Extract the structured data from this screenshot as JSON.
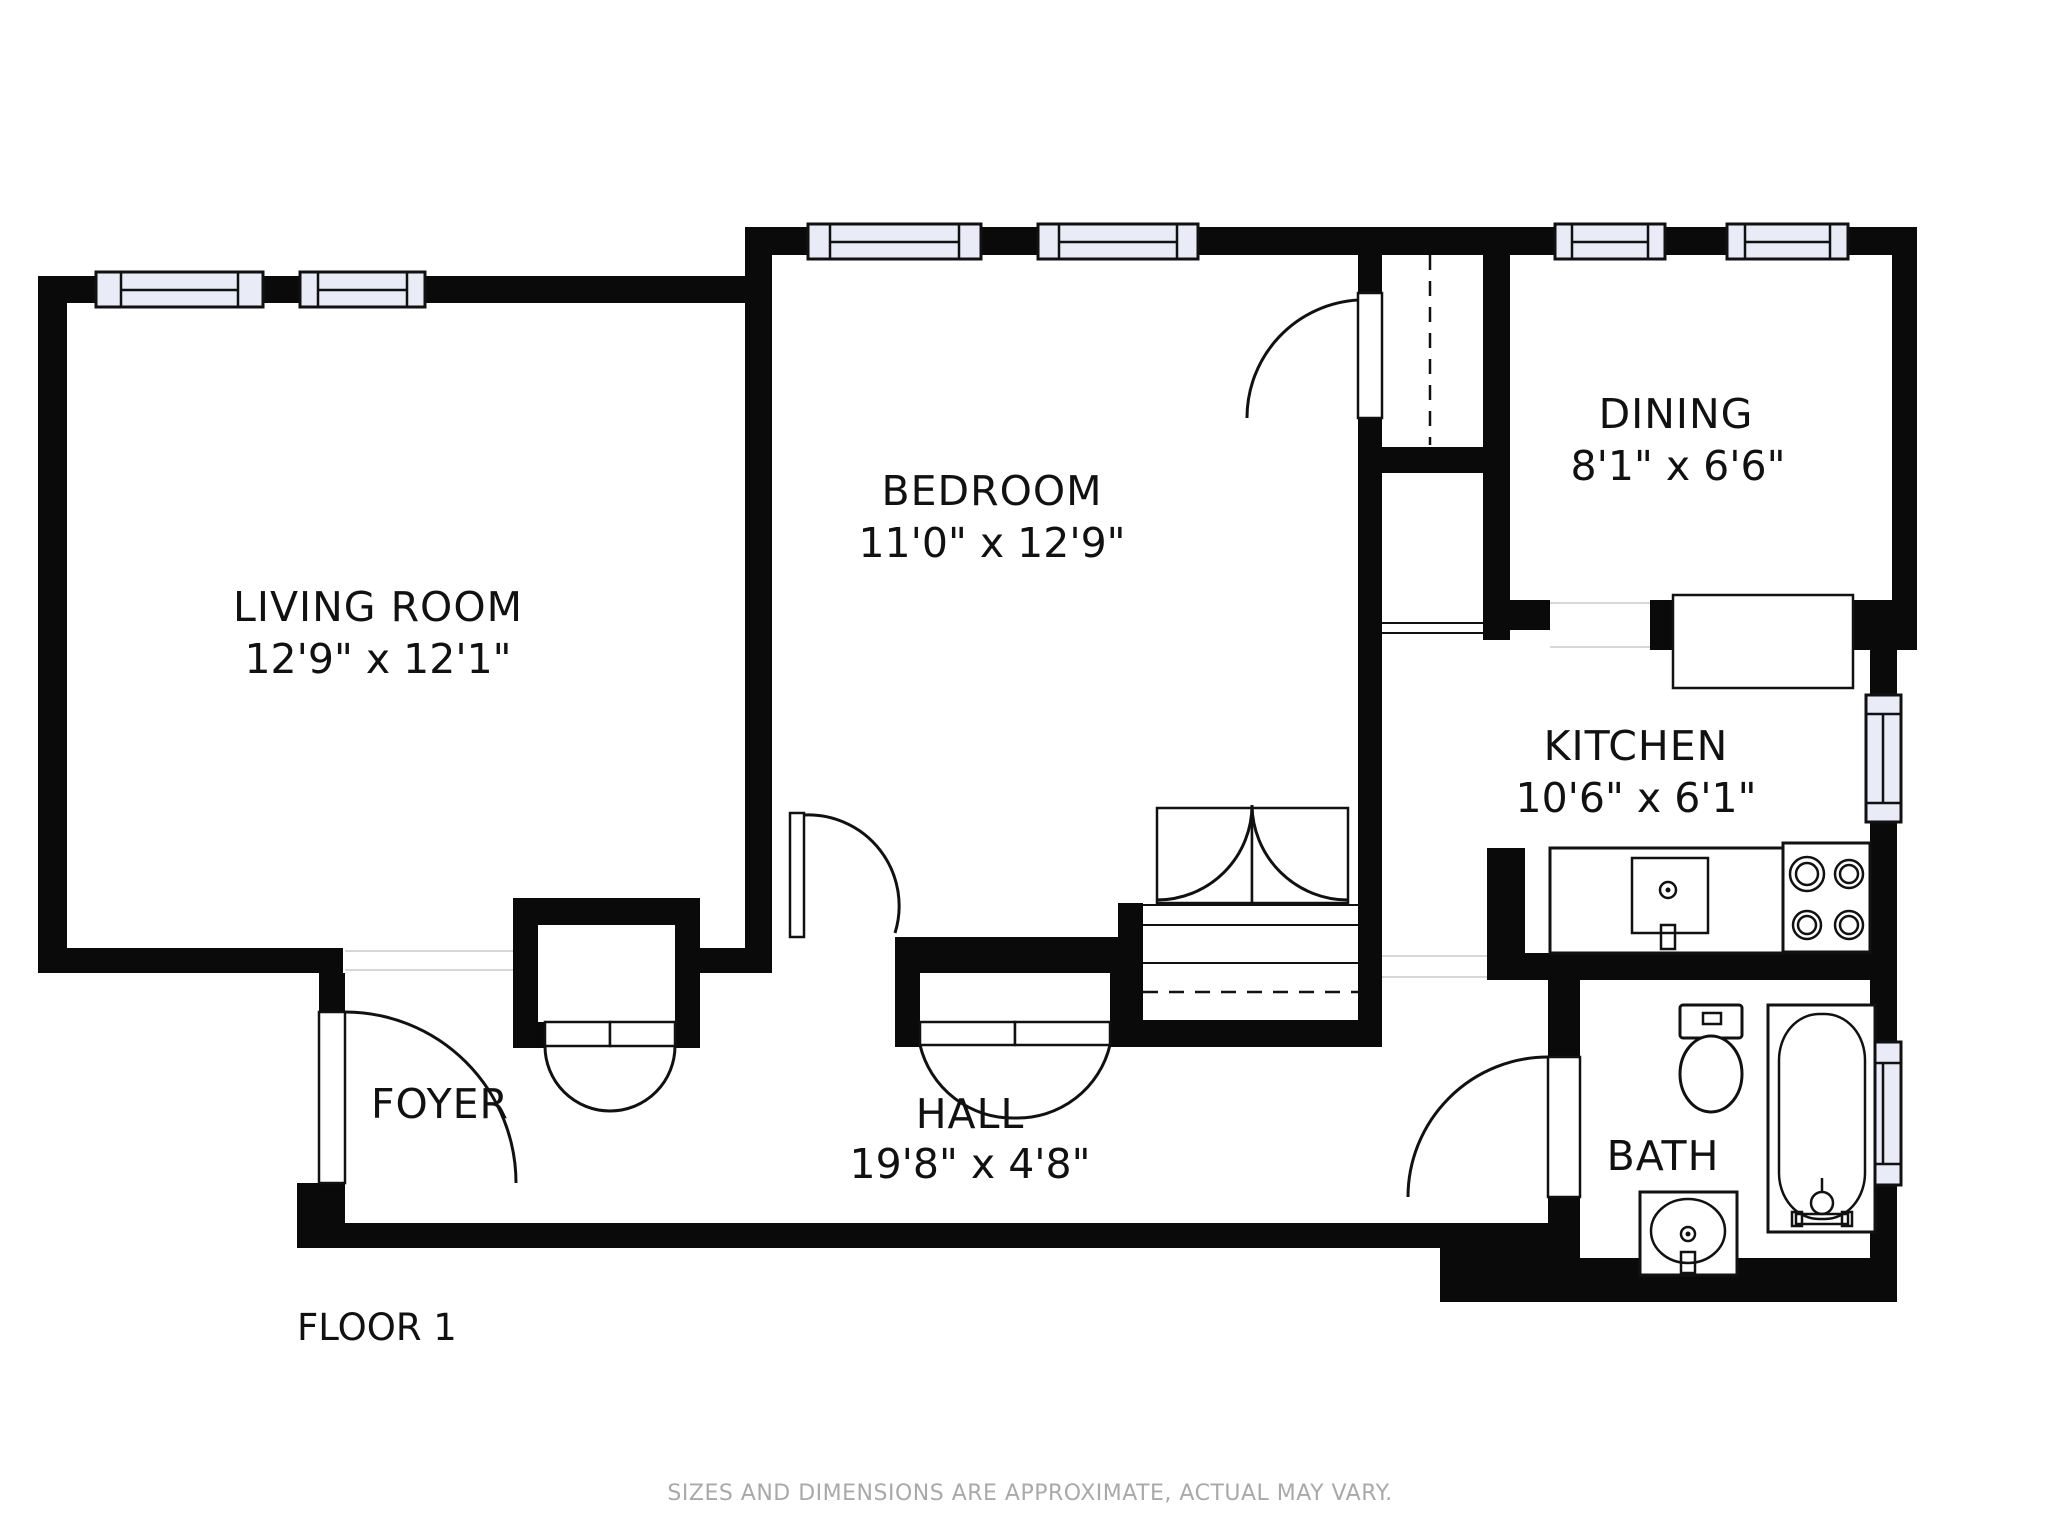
{
  "floorplan": {
    "floor_label": "FLOOR 1",
    "disclaimer": "SIZES AND DIMENSIONS ARE APPROXIMATE, ACTUAL MAY VARY.",
    "colors": {
      "wall": "#0a0a0a",
      "window_fill": "#e9ebf7",
      "label_text": "#111111",
      "disclaimer_text": "#a9a9a9"
    },
    "rooms": {
      "living_room": {
        "name": "LIVING ROOM",
        "dims": "12'9\" x 12'1\""
      },
      "bedroom": {
        "name": "BEDROOM",
        "dims": "11'0\" x 12'9\""
      },
      "dining": {
        "name": "DINING",
        "dims": "8'1\" x 6'6\""
      },
      "kitchen": {
        "name": "KITCHEN",
        "dims": "10'6\" x 6'1\""
      },
      "hall": {
        "name": "HALL",
        "dims": "19'8\" x 4'8\""
      },
      "foyer": {
        "name": "FOYER"
      },
      "bath": {
        "name": "BATH"
      }
    },
    "fixtures": [
      "stove",
      "kitchen-sink",
      "counter",
      "breakfast-bar",
      "toilet",
      "bathtub",
      "bath-sink"
    ]
  }
}
